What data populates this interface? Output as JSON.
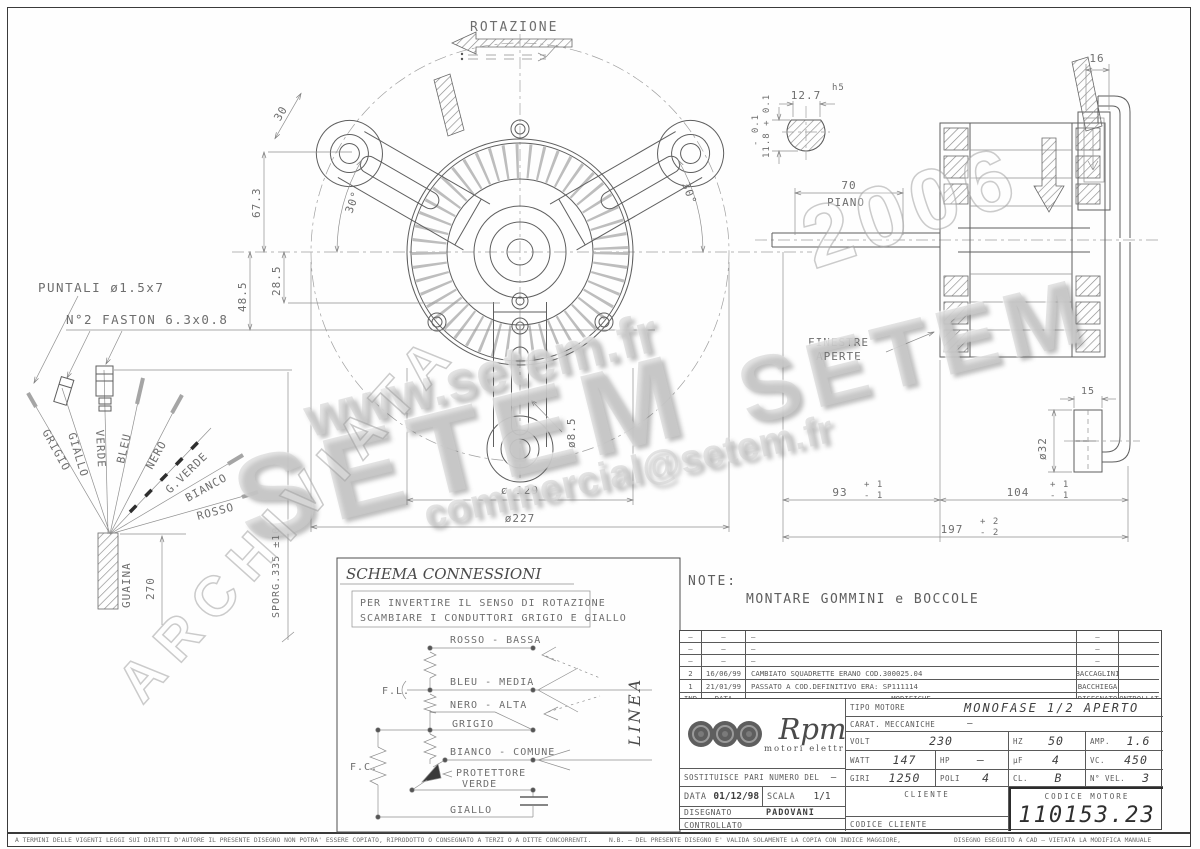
{
  "colors": {
    "paper": "#fefefe",
    "line": "#5f5f5f",
    "frame": "#3a3a3a",
    "watermark": "#cdcdcd"
  },
  "rotation": {
    "label": "ROTAZIONE"
  },
  "front_view": {
    "arm_width": "30",
    "dim_67": "67.3",
    "dim_48": "48.5",
    "dim_28": "28.5",
    "angle_left": "30°",
    "angle_right": "30°",
    "dia_hole": "ø8.5",
    "dia_129": "ø 129",
    "dia_227": "ø227"
  },
  "cable": {
    "puntali_label": "PUNTALI ø1.5x7",
    "faston_label": "N°2 FASTON 6.3x0.8",
    "wires": [
      {
        "label": "GRIGIO"
      },
      {
        "label": "GIALLO"
      },
      {
        "label": "VERDE"
      },
      {
        "label": "BLEU"
      },
      {
        "label": "NERO"
      },
      {
        "label": "G.VERDE"
      },
      {
        "label": "BIANCO"
      },
      {
        "label": "ROSSO"
      }
    ],
    "sheath_label": "GUAINA",
    "dim_length": "270",
    "sporgenza": "SPORG.335 ±10"
  },
  "side_view": {
    "dim_16": "16",
    "shaft_w": "12.7",
    "shaft_w_tol": "h5",
    "shaft_h": "11.8 + 0.1",
    "shaft_h_tol": "- 0.1",
    "dim_70": "70",
    "piano": "PIANO",
    "finestre_line1": "FINESTRE",
    "finestre_line2": "APERTE",
    "dim_93": "93",
    "t93p": "+ 1",
    "t93m": "- 1",
    "dim_104": "104",
    "t104p": "+ 1",
    "t104m": "- 1",
    "dim_197": "197",
    "t197p": "+ 2",
    "t197m": "- 2",
    "dim_15": "15",
    "dia_32": "ø32"
  },
  "schema": {
    "title": "SCHEMA CONNESSIONI",
    "note_line1": "PER INVERTIRE IL SENSO DI ROTAZIONE",
    "note_line2": "SCAMBIARE I CONDUTTORI GRIGIO E GIALLO",
    "rosso": "ROSSO - BASSA",
    "bleu": "BLEU - MEDIA",
    "nero": "NERO - ALTA",
    "grigio": "GRIGIO",
    "bianco": "BIANCO - COMUNE",
    "protettore": "PROTETTORE",
    "verde": "VERDE",
    "giallo": "GIALLO",
    "fl": "F.L.",
    "fc": "F.C.",
    "linea": "LINEA"
  },
  "note": {
    "label": "NOTE:",
    "text": "MONTARE GOMMINI e BOCCOLE"
  },
  "revisions": {
    "headers": {
      "ind": "IND",
      "data": "DATA",
      "modifiche": "MODIFICHE",
      "disegnato": "DISEGNATO",
      "controllato": "CONTROLLATO"
    },
    "rows": [
      {
        "ind": "–",
        "data": "–",
        "modifiche": "–",
        "disegnato": "–",
        "controllato": ""
      },
      {
        "ind": "–",
        "data": "–",
        "modifiche": "–",
        "disegnato": "–",
        "controllato": ""
      },
      {
        "ind": "–",
        "data": "–",
        "modifiche": "–",
        "disegnato": "–",
        "controllato": ""
      },
      {
        "ind": "2",
        "data": "16/06/99",
        "modifiche": "CAMBIATO SQUADRETTE ERANO COD.300025.04",
        "disegnato": "BACCAGLINI",
        "controllato": ""
      },
      {
        "ind": "1",
        "data": "21/01/99",
        "modifiche": "PASSATO A COD.DEFINITIVO ERA: SP111114",
        "disegnato": "BACCHIEGA",
        "controllato": ""
      }
    ]
  },
  "titleblock": {
    "brand": {
      "name": "Rpm",
      "tagline": "motori elettrici"
    },
    "sostituisce_label": "SOSTITUISCE PARI NUMERO DEL",
    "sostituisce_value": "–",
    "data_label": "DATA",
    "data_value": "01/12/98",
    "scala_label": "SCALA",
    "scala_value": "1/1",
    "disegnato_label": "DISEGNATO",
    "disegnato_value": "PADOVANI",
    "controllato_label": "CONTROLLATO",
    "controllato_value": "",
    "tipo_label": "TIPO MOTORE",
    "tipo_value": "MONOFASE 1/2 APERTO",
    "carat_label": "CARAT. MECCANICHE",
    "carat_value": "–",
    "volt_label": "VOLT",
    "volt_value": "230",
    "hz_label": "HZ",
    "hz_value": "50",
    "amp_label": "AMP.",
    "amp_value": "1.6",
    "watt_label": "WATT",
    "watt_value": "147",
    "hp_label": "HP",
    "hp_value": "–",
    "uf_label": "µF",
    "uf_value": "4",
    "vc_label": "VC.",
    "vc_value": "450",
    "giri_label": "GIRI",
    "giri_value": "1250",
    "poli_label": "POLI",
    "poli_value": "4",
    "cl_label": "CL.",
    "cl_value": "B",
    "nvel_label": "N° VEL.",
    "nvel_value": "3",
    "cliente_label": "CLIENTE",
    "codice_cliente_label": "CODICE CLIENTE",
    "codice_motore_label": "CODICE MOTORE",
    "codice_motore_value": "110153.23"
  },
  "legal": {
    "left": "A TERMINI DELLE VIGENTI LEGGI SUI DIRITTI D'AUTORE IL PRESENTE DISEGNO NON POTRA' ESSERE COPIATO, RIPRODOTTO O CONSEGNATO A TERZI O A DITTE CONCORRENTI.",
    "mid": "N.B. – DEL PRESENTE DISEGNO E' VALIDA SOLAMENTE LA COPIA CON INDICE MAGGIORE,",
    "right": "DISEGNO ESEGUITO A CAD – VIETATA LA MODIFICA MANUALE"
  },
  "watermarks": {
    "url": "www.setem.fr",
    "setem1": "SETEM",
    "setem2": "SETEM",
    "email": "commercial@setem.fr",
    "archiviata": "ARCHIVIATA",
    "anno": "2006"
  }
}
